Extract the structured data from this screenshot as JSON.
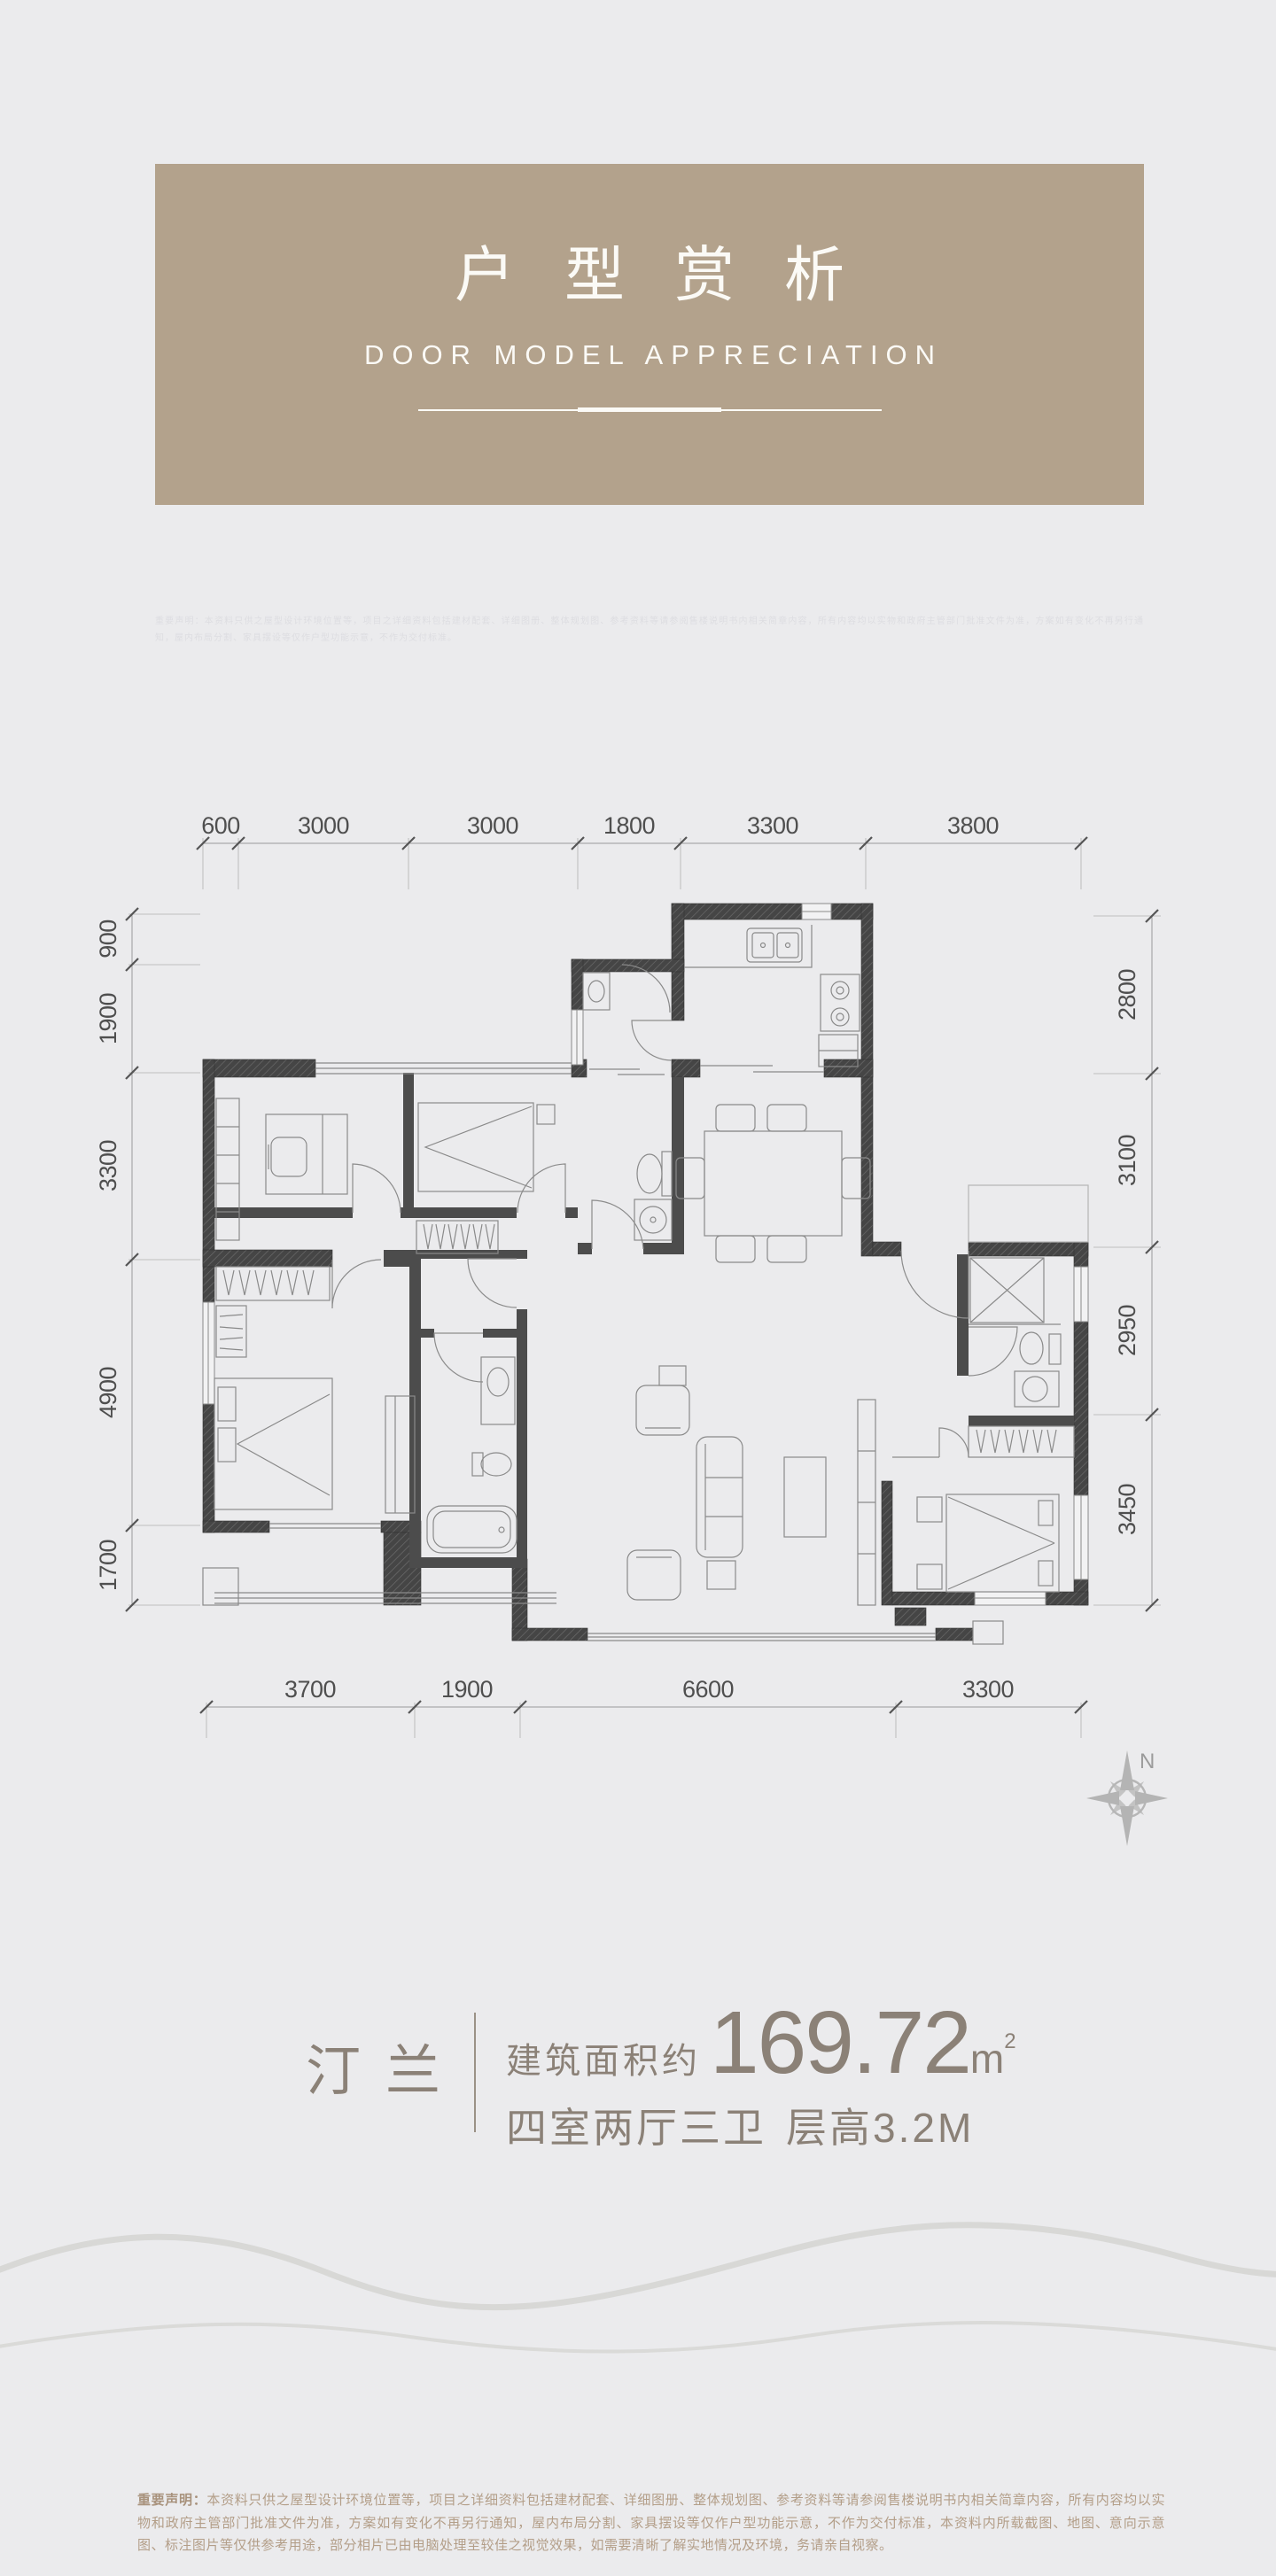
{
  "header": {
    "title": "户型赏析",
    "subtitle": "DOOR MODEL APPRECIATION",
    "note": "重要声明：本资料只供之屋型设计环境位置等，项目之详细资料包括建材配套、详细图册、整体规划图、参考资料等请参阅售楼说明书内相关简章内容，所有内容均以实物和政府主管部门批准文件为准，方案如有变化不再另行通知，屋内布局分割、家具摆设等仅作户型功能示意，不作为交付标准。"
  },
  "dims": {
    "top": [
      "600",
      "3000",
      "3000",
      "1800",
      "3300",
      "3800"
    ],
    "left": [
      "900",
      "1900",
      "3300",
      "4900",
      "1700"
    ],
    "right": [
      "2800",
      "3100",
      "2950",
      "3450"
    ],
    "bottom": [
      "3700",
      "1900",
      "6600",
      "3300"
    ]
  },
  "compass": {
    "north_label": "N"
  },
  "unit": {
    "name": "汀兰",
    "area_label": "建筑面积约",
    "area_value": "169.72",
    "area_unit_base": "m",
    "area_unit_sup": "2",
    "layout": "四室两厅三卫",
    "height_label": "层高3.2M"
  },
  "legal": {
    "label": "重要声明：",
    "text": "本资料只供之屋型设计环境位置等，项目之详细资料包括建材配套、详细图册、整体规划图、参考资料等请参阅售楼说明书内相关简章内容，所有内容均以实物和政府主管部门批准文件为准，方案如有变化不再另行通知，屋内布局分割、家具摆设等仅作户型功能示意，不作为交付标准，本资料内所载截图、地图、意向示意图、标注图片等仅供参考用途，部分相片已由电脑处理至较佳之视觉效果，如需要清晰了解实地情况及环境，务请亲自视察。"
  },
  "colors": {
    "background": "#ebebed",
    "banner": "#b3a28c",
    "banner_text": "#fbfaf6",
    "wall": "#454545",
    "plan_line": "#8a8a8a",
    "dim_text": "#4f4f4f",
    "unit_text": "#8b8177",
    "legal_text": "#b39e88"
  }
}
